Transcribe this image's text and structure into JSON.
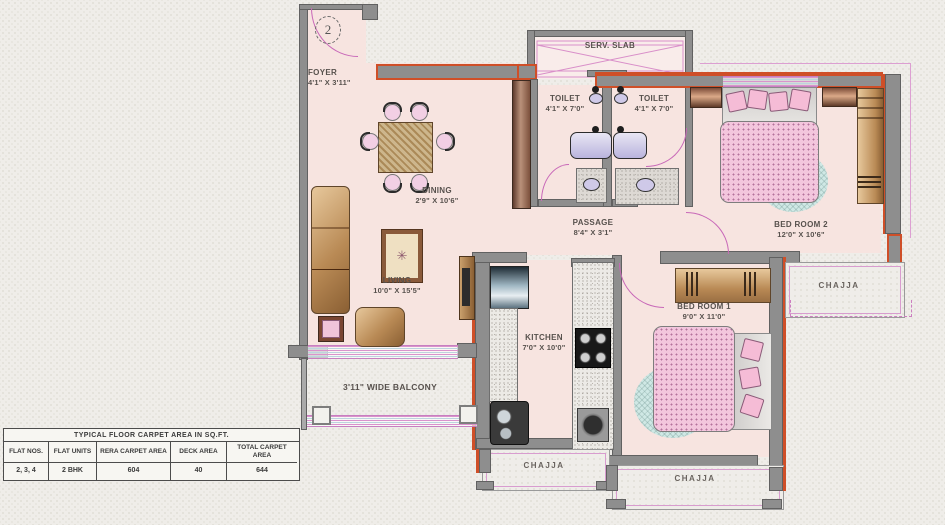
{
  "plan": {
    "flat_number": "2",
    "rooms": {
      "foyer": {
        "name": "FOYER",
        "dims": "4'1\" X 3'11\""
      },
      "dining": {
        "name": "DINING",
        "dims": "2'9\" X 10'6\""
      },
      "living": {
        "name": "LIVING",
        "dims": "10'0\" X 15'5\""
      },
      "serv_slab": {
        "name": "SERV. SLAB"
      },
      "toilet1": {
        "name": "TOILET",
        "dims": "4'1\" X 7'0\""
      },
      "toilet2": {
        "name": "TOILET",
        "dims": "4'1\" X 7'0\""
      },
      "passage": {
        "name": "PASSAGE",
        "dims": "8'4\" X 3'1\""
      },
      "bedroom2": {
        "name": "BED ROOM 2",
        "dims": "12'0\" X 10'6\""
      },
      "bedroom1": {
        "name": "BED ROOM 1",
        "dims": "9'0\" X 11'0\""
      },
      "kitchen": {
        "name": "KITCHEN",
        "dims": "7'0\" X 10'0\""
      },
      "balcony": {
        "name": "3'11\" WIDE BALCONY"
      },
      "chajja_right": {
        "name": "CHAJJA"
      },
      "chajja_bottom_left": {
        "name": "CHAJJA"
      },
      "chajja_bottom_right": {
        "name": "CHAJJA"
      }
    }
  },
  "area_table": {
    "title": "TYPICAL FLOOR CARPET AREA IN SQ.FT.",
    "columns": [
      "FLAT NOS.",
      "FLAT UNITS",
      "RERA CARPET AREA",
      "DECK AREA",
      "TOTAL CARPET AREA"
    ],
    "rows": [
      [
        "2, 3, 4",
        "2 BHK",
        "604",
        "40",
        "644"
      ]
    ]
  },
  "colors": {
    "background": "#efede9",
    "room_fill": "#f7e4e0",
    "wall_gray": "#8e8e8e",
    "accent_orange": "#cf4f28",
    "door_magenta": "#c868b8",
    "bed_pink": "#f3c6dd",
    "furniture_tan": "#b98a55",
    "rug_teal": "#cfe8e5"
  }
}
